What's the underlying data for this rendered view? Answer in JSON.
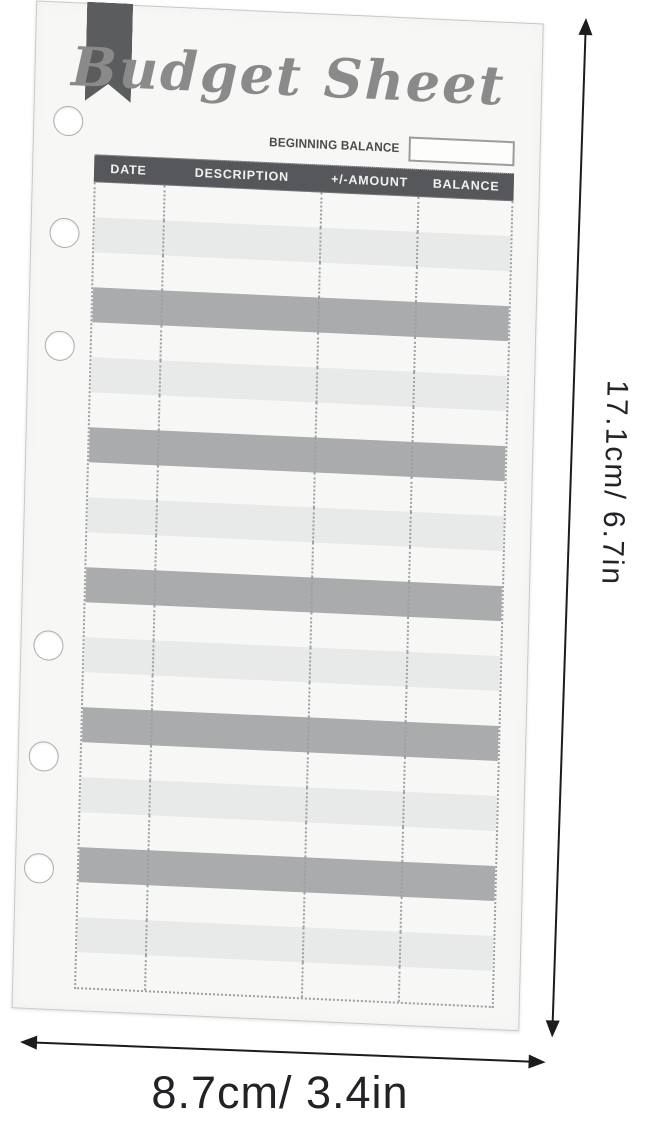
{
  "sheet": {
    "title": "Budget Sheet",
    "beginning_balance_label": "BEGINNING BALANCE",
    "beginning_balance_value": "",
    "table": {
      "columns": [
        "DATE",
        "DESCRIPTION",
        "+/-AMOUNT",
        "BALANCE"
      ],
      "rows_total": 23,
      "cells_empty": true,
      "row_shades": [
        "white",
        "light",
        "white",
        "dark",
        "white",
        "light",
        "white",
        "dark",
        "white",
        "light",
        "white",
        "dark",
        "white",
        "light",
        "white",
        "dark",
        "white",
        "light",
        "white",
        "dark",
        "white",
        "light",
        "white"
      ]
    },
    "binder_holes": 6
  },
  "dimensions": {
    "height_label": "17.1cm/ 6.7in",
    "width_label": "8.7cm/ 3.4in"
  },
  "colors": {
    "paper": "#f7f7f5",
    "header_bg": "#56575a",
    "row_light": "#e8e9e9",
    "row_dark": "#a9abac",
    "dotted": "#9aa0a3",
    "ribbon": "#5b5c5e",
    "title_ink": "#8a8a8a",
    "label_ink": "#4b4b4d",
    "arrow_ink": "#1c1c1c",
    "dim_ink": "#222326"
  }
}
